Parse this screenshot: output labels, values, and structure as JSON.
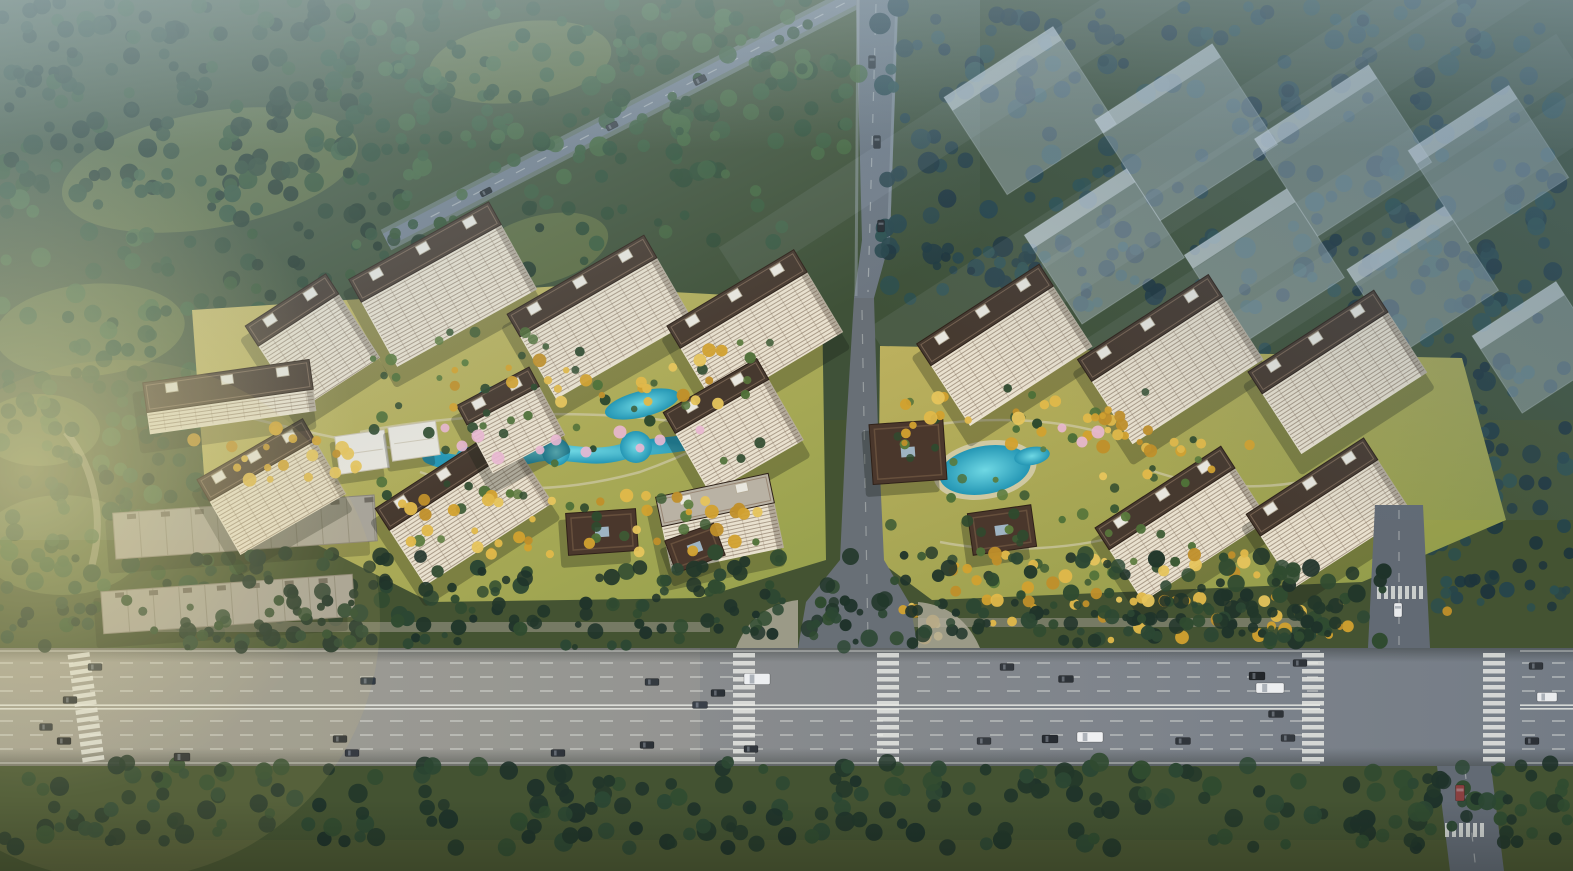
{
  "meta": {
    "type": "aerial-architectural-rendering",
    "subject": "bird's-eye masterplan rendering of a residential development with high-rise towers, landscaped courtyards with pools, perimeter forest, a wide boulevard with traffic, and translucent future-phase building massing",
    "canvas": {
      "width": 1573,
      "height": 871
    }
  },
  "palette": {
    "ground_base": "#3f5138",
    "meadow": "#5e6e41",
    "meadow_light": "#78793f",
    "forest_dark": [
      "#1f3326",
      "#2a432f",
      "#24392a",
      "#31502f"
    ],
    "forest_mid": [
      "#2d4a33",
      "#3a5c3c",
      "#2f4f36",
      "#44663f"
    ],
    "forest_blue": [
      "#203a40",
      "#27454a",
      "#1d343c",
      "#2c4f4e"
    ],
    "roadside_green": [
      "#22372a",
      "#2c4733",
      "#1f332a",
      "#304b30"
    ],
    "courtyard_green": [
      "#3d5a34",
      "#4f7038",
      "#2f4a2e",
      "#5a7a3c"
    ],
    "gold_trees": [
      "#d2a12f",
      "#e0b84a",
      "#c08f2a",
      "#e6c45c"
    ],
    "blossom_pink": "#e9b7d2",
    "lawn_west_a": "#c6b766",
    "lawn_west_b": "#95a04c",
    "lawn_east_a": "#bcb05e",
    "lawn_east_b": "#8d9a48",
    "road_main_a": "#9c9a90",
    "road_main_b": "#8b8d8e",
    "road_main_c": "#747c86",
    "road_access": "#686f76",
    "road_north": "#6d7680",
    "road_leg": "#626a74",
    "road_diagonal": "#727e8c",
    "marking_white": "#eef0ea",
    "sidewalk": "#a8a295",
    "facade_light": "#e9e1cf",
    "floor_line": "#6e5a46",
    "roof_brown": "#46392f",
    "roof_trim": "#8a7460",
    "roof_light": "#b9b2a4",
    "roof_white_box": "#e9e7df",
    "pavilion_brown": "#4a372c",
    "pavilion_ridge": "#6b5340",
    "white_pavilion": "#e7e5dd",
    "warehouse_roof": "#a8a499",
    "warehouse_seam": "#8a8578",
    "pool_a": "#6fd8e4",
    "pool_b": "#2496b4",
    "ghost_fill": "rgba(203,216,228,0.38)",
    "ghost_roof": "rgba(230,238,245,0.5)",
    "shadow": "#131a13",
    "haze_nw": "rgba(168,192,202,0.55)",
    "haze_ne": "rgba(88,118,142,0.5)",
    "sun_glow": "rgba(238,228,170,0.55)"
  },
  "terrain": {
    "meadows": [
      [
        210,
        170,
        150,
        58,
        -10
      ],
      [
        90,
        330,
        95,
        46,
        -5
      ],
      [
        62,
        545,
        82,
        50,
        0
      ],
      [
        540,
        250,
        70,
        34,
        -15
      ],
      [
        520,
        62,
        92,
        40,
        -8
      ],
      [
        40,
        430,
        60,
        36,
        0
      ]
    ],
    "lawn_west_path": "M192,310 L560,286 L822,300 L826,560 L700,598 L430,602 L205,488 Z",
    "lawn_east_path": "M880,346 L1462,358 L1506,520 L1362,582 L932,600 L878,560 Z",
    "bottom_lawn": [
      0,
      840,
      1573,
      31
    ]
  },
  "vegetation": {
    "forest_regions": [
      [
        0,
        0,
        360,
        190,
        150,
        "forest_dark",
        5,
        10
      ],
      [
        300,
        0,
        560,
        180,
        170,
        "forest_mid",
        5,
        10
      ],
      [
        0,
        160,
        260,
        270,
        100,
        "forest_mid",
        5,
        10
      ],
      [
        210,
        190,
        330,
        130,
        60,
        "forest_dark",
        4,
        9
      ],
      [
        0,
        410,
        210,
        180,
        60,
        "forest_mid",
        5,
        10
      ],
      [
        60,
        455,
        350,
        180,
        55,
        "forest_dark",
        4,
        8
      ],
      [
        880,
        0,
        680,
        290,
        210,
        "forest_blue",
        5,
        11
      ],
      [
        1140,
        240,
        430,
        300,
        150,
        "forest_blue",
        5,
        10
      ],
      [
        880,
        245,
        270,
        70,
        40,
        "forest_blue",
        4,
        8
      ],
      [
        355,
        35,
        430,
        230,
        60,
        "forest_mid",
        4,
        8
      ],
      [
        1355,
        390,
        150,
        115,
        36,
        "forest_blue",
        4,
        8
      ],
      [
        1430,
        540,
        143,
        70,
        28,
        "forest_blue",
        4,
        8
      ]
    ],
    "verge_regions": [
      [
        180,
        552,
        690,
        92,
        120,
        "roadside_green",
        4,
        9
      ],
      [
        880,
        552,
        510,
        92,
        105,
        "roadside_green",
        4,
        9
      ],
      [
        0,
        600,
        870,
        48,
        80,
        "roadside_green",
        3,
        7
      ],
      [
        880,
        600,
        460,
        44,
        60,
        "roadside_green",
        3,
        7
      ],
      [
        0,
        762,
        1580,
        86,
        260,
        "roadside_green",
        5,
        10
      ]
    ],
    "courtyard_regions": [
      [
        350,
        330,
        430,
        220,
        70,
        "courtyard_green",
        3,
        6
      ],
      [
        885,
        385,
        330,
        200,
        55,
        "courtyard_green",
        3,
        6
      ]
    ],
    "gold_regions": [
      [
        395,
        495,
        380,
        60,
        40
      ],
      [
        185,
        420,
        185,
        65,
        22
      ],
      [
        890,
        392,
        240,
        55,
        26
      ],
      [
        940,
        552,
        330,
        52,
        30
      ],
      [
        840,
        598,
        390,
        42,
        22
      ],
      [
        1240,
        596,
        210,
        40,
        16
      ],
      [
        420,
        350,
        330,
        60,
        24
      ],
      [
        1090,
        430,
        160,
        50,
        14
      ]
    ],
    "blossoms": [
      [
        445,
        428
      ],
      [
        462,
        446
      ],
      [
        478,
        436
      ],
      [
        540,
        450
      ],
      [
        556,
        440
      ],
      [
        620,
        432
      ],
      [
        640,
        448
      ],
      [
        660,
        440
      ],
      [
        498,
        458
      ],
      [
        1062,
        428
      ],
      [
        1082,
        442
      ],
      [
        1098,
        432
      ],
      [
        700,
        430
      ],
      [
        586,
        452
      ]
    ]
  },
  "water": {
    "west_stream_path": "M430,456 C462,470 500,462 532,455 C566,447 586,462 622,452 C652,444 672,448 702,438",
    "west_blobs": [
      [
        468,
        460,
        13
      ],
      [
        556,
        452,
        14
      ],
      [
        636,
        447,
        16
      ],
      [
        693,
        439,
        11
      ]
    ],
    "west_ponds": [
      [
        642,
        404,
        38,
        13,
        -14
      ],
      [
        498,
        392,
        20,
        7,
        -10
      ]
    ],
    "east_pool": [
      985,
      470,
      46,
      24,
      -10
    ],
    "east_lagoon": [
      1032,
      456,
      18,
      9,
      -10
    ]
  },
  "walkways": {
    "west": [
      "M360,432 C420,420 520,410 620,416 C680,420 742,432 772,452",
      "M420,472 C480,494 560,494 640,472 C668,462 690,452 706,444",
      "M250,418 C300,430 340,440 392,448"
    ],
    "east": [
      "M900,432 C960,416 1040,416 1100,432",
      "M940,542 C1000,554 1080,550 1140,530",
      "M1150,470 C1200,488 1260,492 1320,478"
    ]
  },
  "buildings": {
    "west_towers": [
      [
        425,
        252,
        160,
        26,
        74,
        -29
      ],
      [
        582,
        286,
        158,
        26,
        72,
        -30
      ],
      [
        737,
        299,
        148,
        26,
        70,
        -31
      ],
      [
        292,
        310,
        96,
        24,
        76,
        -33
      ],
      [
        256,
        460,
        122,
        25,
        62,
        -30
      ],
      [
        446,
        478,
        152,
        26,
        66,
        -33
      ],
      [
        498,
        396,
        82,
        22,
        55,
        -28
      ],
      [
        716,
        396,
        108,
        24,
        70,
        -30
      ]
    ],
    "west_low": [
      [
        228,
        386,
        168,
        30,
        22,
        -8
      ]
    ],
    "west_midrise": [
      [
        715,
        500,
        115,
        30,
        46,
        -12
      ]
    ],
    "east_towers": [
      [
        985,
        315,
        146,
        26,
        72,
        -33
      ],
      [
        1150,
        328,
        156,
        26,
        75,
        -33
      ],
      [
        1318,
        342,
        150,
        26,
        72,
        -33
      ],
      [
        1165,
        498,
        150,
        26,
        62,
        -33
      ],
      [
        1312,
        487,
        140,
        26,
        62,
        -33
      ]
    ],
    "ghost_towers": [
      [
        1005,
        72,
        130,
        24,
        92,
        -33
      ],
      [
        1160,
        92,
        140,
        24,
        96,
        -33
      ],
      [
        1318,
        112,
        136,
        24,
        92,
        -33
      ],
      [
        1465,
        128,
        120,
        24,
        86,
        -33
      ],
      [
        1082,
        212,
        122,
        24,
        82,
        -33
      ],
      [
        1242,
        232,
        122,
        24,
        82,
        -33
      ],
      [
        1402,
        248,
        116,
        24,
        76,
        -33
      ],
      [
        1520,
        318,
        100,
        22,
        70,
        -33
      ]
    ],
    "warehouses": [
      [
        245,
        527,
        262,
        46,
        -4
      ],
      [
        228,
        604,
        252,
        42,
        -4
      ]
    ],
    "pavilions": [
      [
        602,
        532,
        70,
        42,
        -4
      ],
      [
        695,
        548,
        52,
        34,
        -20
      ],
      [
        908,
        452,
        74,
        60,
        -4
      ],
      [
        1002,
        530,
        64,
        42,
        -8
      ]
    ],
    "white_pavilions": [
      [
        362,
        452,
        50,
        38,
        -8
      ],
      [
        414,
        441,
        48,
        34,
        -8
      ]
    ]
  },
  "roads": {
    "boulevard": {
      "y": 648,
      "h": 118,
      "median_ys": [
        705.2,
        708.8
      ],
      "dash_rows_upper": [
        663,
        677,
        691
      ],
      "dash_rows_lower": [
        721,
        735,
        749
      ],
      "edge_ys": [
        651,
        763
      ],
      "upper_dash_segments": [
        [
          0,
          733
        ],
        [
          917,
          1318
        ],
        [
          1522,
          1573
        ]
      ],
      "lower_dash_segments": [
        [
          0,
          1318
        ],
        [
          1522,
          1573
        ]
      ],
      "median_segments": [
        [
          0,
          1320
        ],
        [
          1520,
          1573
        ]
      ],
      "crosswalk_centers": [
        86,
        744,
        888,
        1313,
        1494
      ],
      "mouth_gap": [
        798,
        918
      ]
    },
    "access_path": "M854,298 L874,298 L878,430 L884,560 L910,604 L918,648 L798,648 L806,602 L840,560 L846,430 Z",
    "access_dash": "M862,310 L868,640",
    "north_road_poly": "856,0 898,0 890,240 874,298 854,298 862,240",
    "diagonal_from": [
      866,
      -8
    ],
    "diagonal_to": [
      386,
      240
    ],
    "intersection": {
      "north_leg": "1375,505 1423,505 1430,648 1368,648",
      "south_leg": "1437,766 1491,766 1504,871 1450,871",
      "top_zebra": [
        1377,
        586,
        1421,
        13
      ],
      "bottom_zebra": [
        1445,
        823,
        1487,
        14
      ]
    },
    "left_path": "M66,432 C96,470 104,520 92,565"
  },
  "vehicles": [
    [
      95,
      667,
      14,
      7,
      0,
      "#3a4046"
    ],
    [
      70,
      700,
      14,
      7,
      0,
      "#2b3036"
    ],
    [
      46,
      727,
      13,
      7,
      0,
      "#33383e"
    ],
    [
      64,
      741,
      14,
      7,
      0,
      "#23272c"
    ],
    [
      182,
      757,
      16,
      8,
      0,
      "#2e3236"
    ],
    [
      368,
      681,
      15,
      7,
      0,
      "#303a44"
    ],
    [
      340,
      739,
      14,
      7,
      0,
      "#2a2f35"
    ],
    [
      352,
      753,
      14,
      7,
      0,
      "#363b42"
    ],
    [
      558,
      753,
      14,
      7,
      0,
      "#2f343b"
    ],
    [
      652,
      682,
      14,
      7,
      0,
      "#343a40"
    ],
    [
      718,
      693,
      14,
      7,
      0,
      "#2b3137"
    ],
    [
      700,
      705,
      15,
      7,
      0,
      "#394049"
    ],
    [
      757,
      679,
      26,
      11,
      0,
      "#edeff1"
    ],
    [
      647,
      745,
      14,
      7,
      0,
      "#2c3137"
    ],
    [
      751,
      749,
      14,
      7,
      0,
      "#31363c"
    ],
    [
      1007,
      667,
      14,
      7,
      0,
      "#33383e"
    ],
    [
      1066,
      679,
      15,
      7,
      0,
      "#2d3238"
    ],
    [
      984,
      741,
      14,
      7,
      0,
      "#363b41"
    ],
    [
      1050,
      739,
      16,
      8,
      0,
      "#272c32"
    ],
    [
      1090,
      737,
      26,
      10,
      0,
      "#eff0f2"
    ],
    [
      1183,
      741,
      15,
      7,
      0,
      "#30353b"
    ],
    [
      1257,
      676,
      16,
      8,
      0,
      "#23272b"
    ],
    [
      1270,
      688,
      28,
      10,
      0,
      "#eceef0"
    ],
    [
      1276,
      714,
      15,
      7,
      0,
      "#2e3338"
    ],
    [
      1288,
      738,
      14,
      7,
      0,
      "#34393f"
    ],
    [
      1300,
      663,
      14,
      7,
      0,
      "#2f343a"
    ],
    [
      1536,
      666,
      14,
      7,
      0,
      "#31363c"
    ],
    [
      1547,
      697,
      20,
      9,
      0,
      "#e9ebed"
    ],
    [
      1532,
      741,
      14,
      7,
      0,
      "#2b3036"
    ],
    [
      1398,
      610,
      14,
      8,
      90,
      "#e8eaec"
    ],
    [
      1460,
      793,
      16,
      9,
      90,
      "#8a4040"
    ],
    [
      872,
      62,
      13,
      7,
      90,
      "#262b30"
    ],
    [
      877,
      142,
      13,
      7,
      90,
      "#2e3338"
    ],
    [
      881,
      226,
      12,
      7,
      90,
      "#24282d"
    ],
    [
      700,
      80,
      13,
      7,
      -27,
      "#2d3238"
    ],
    [
      612,
      126,
      12,
      6,
      -27,
      "#383d44"
    ],
    [
      486,
      192,
      12,
      6,
      -27,
      "#23282d"
    ]
  ]
}
